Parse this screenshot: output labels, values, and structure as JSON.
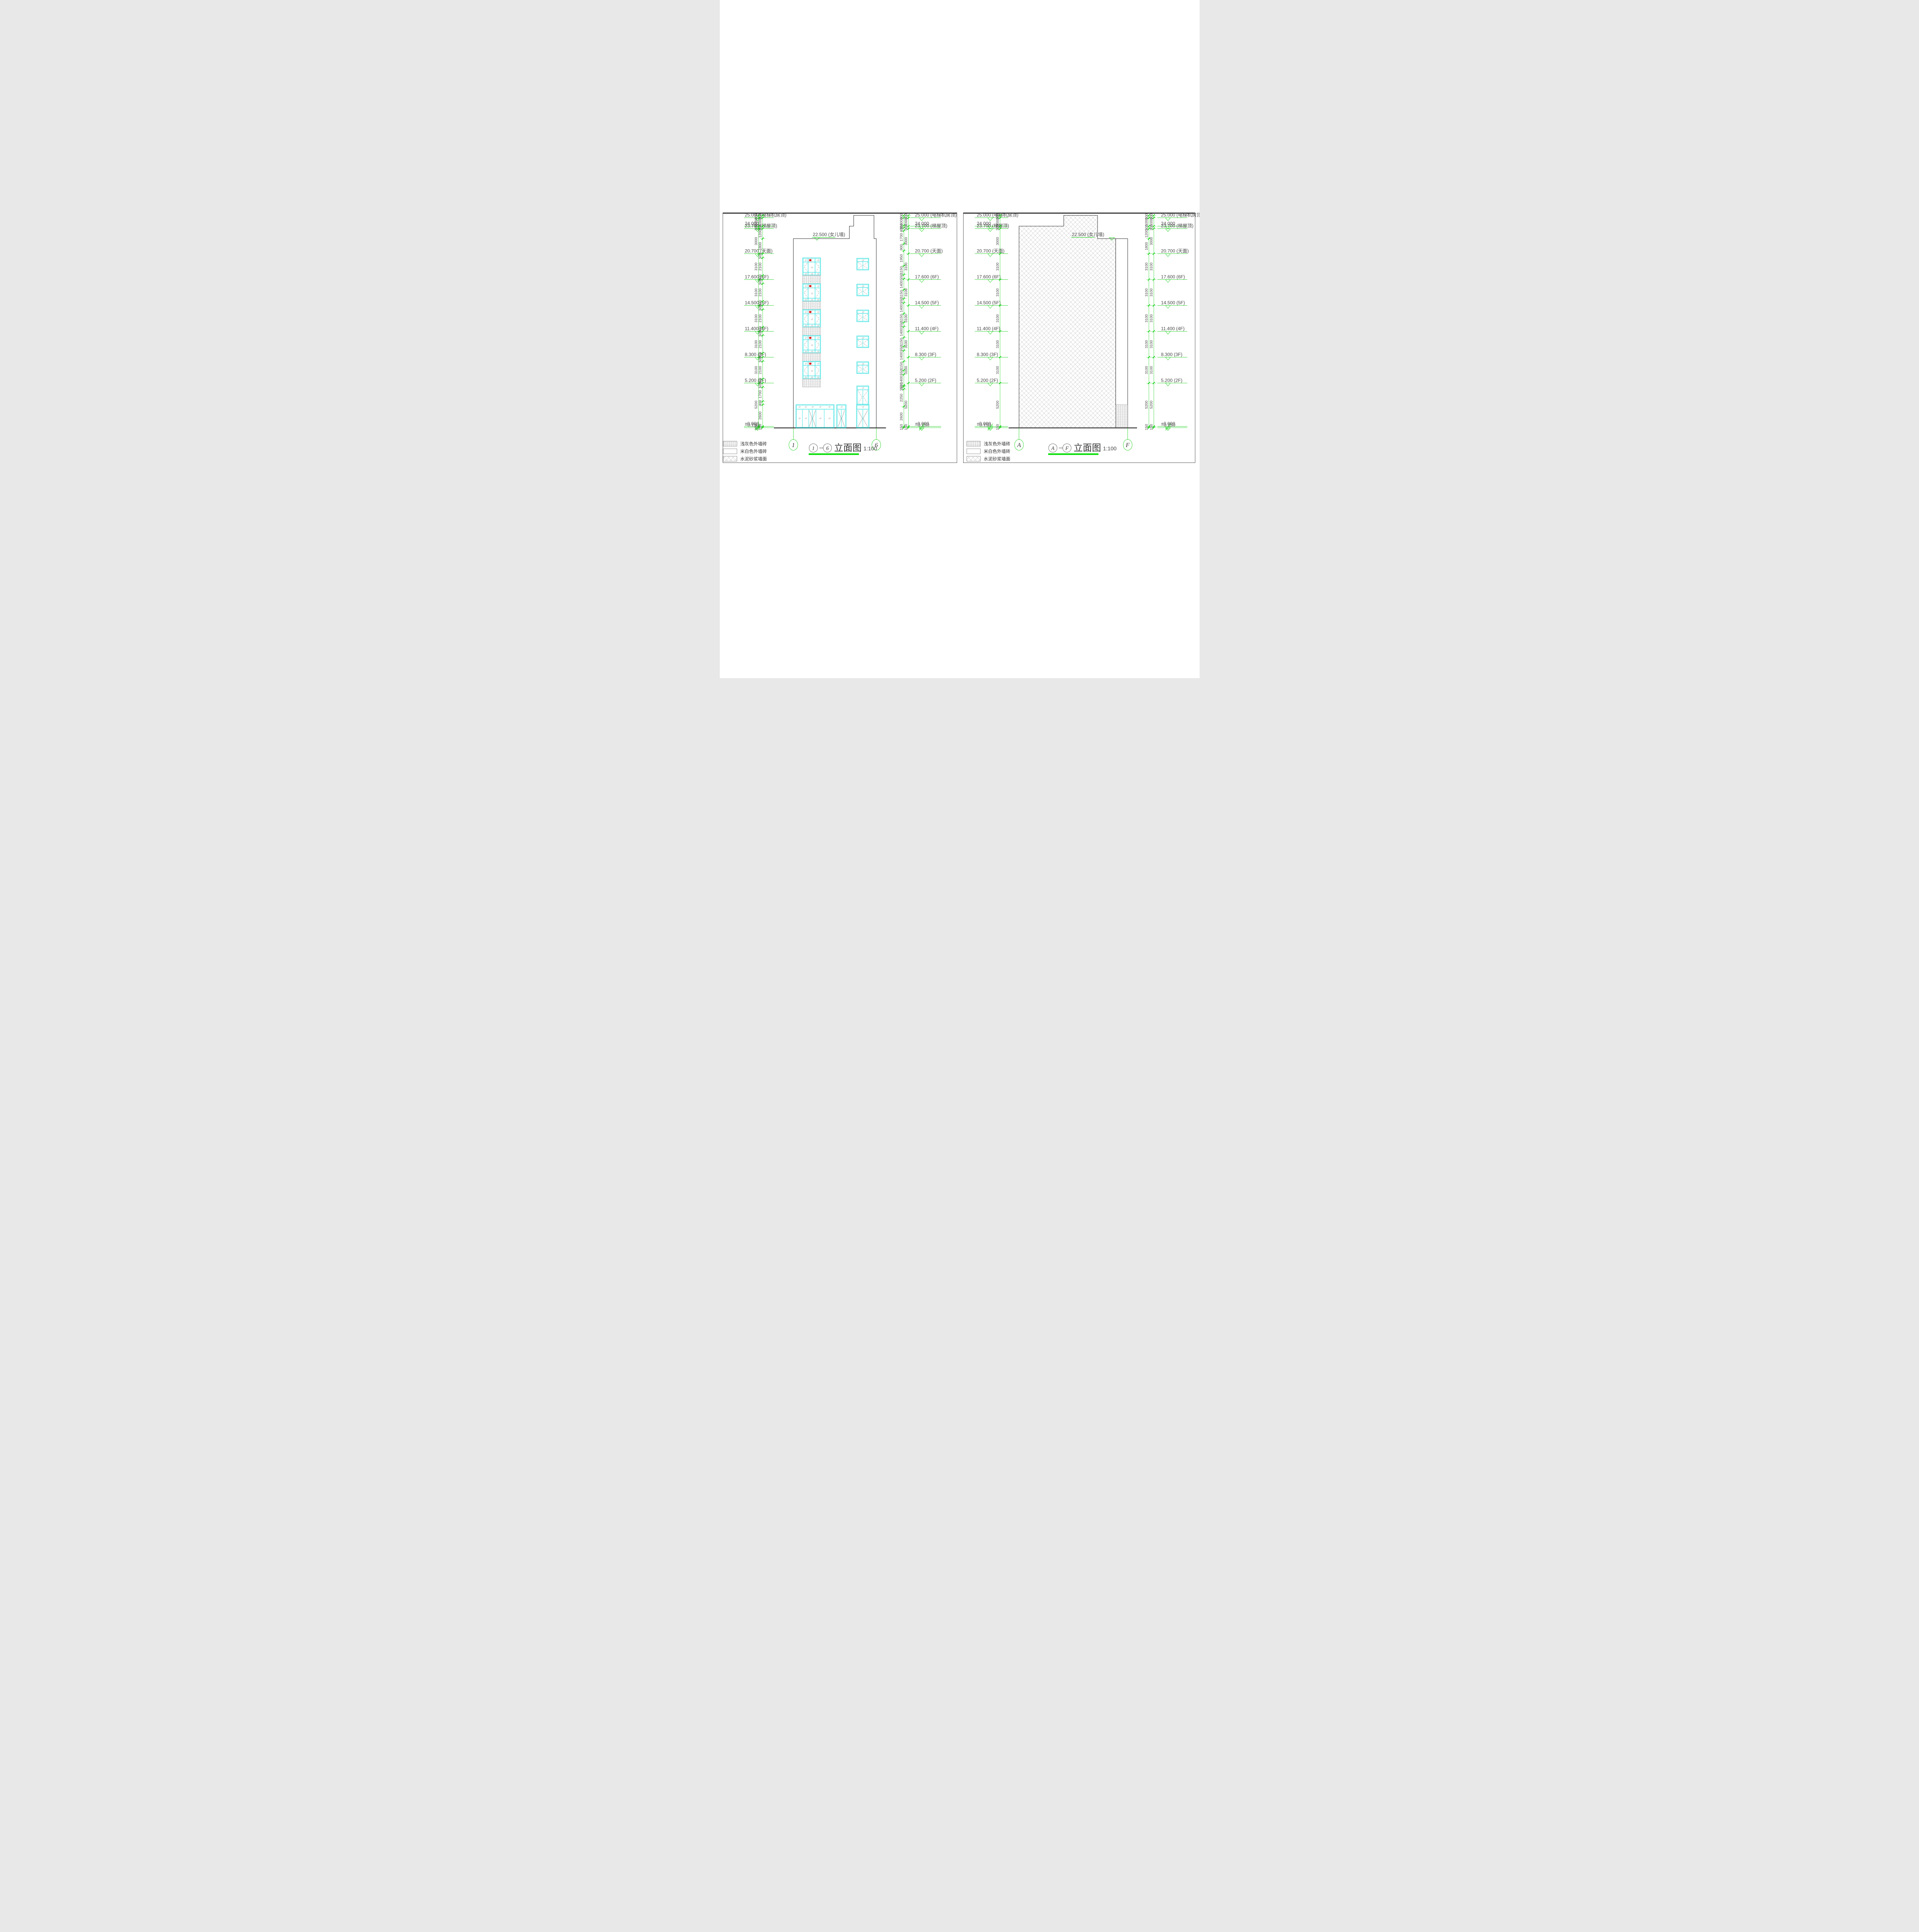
{
  "sheet": {
    "type_note": "architectural elevation sheet",
    "scale_text": "1:100"
  },
  "colors": {
    "cad_green": "#00CC00",
    "title_underline_green": "#00DD00",
    "window_cyan": "#00D8D8",
    "marker_red": "#E01010",
    "line_ink": "#2B2B2B",
    "hatch_gray": "#979797",
    "dim_text": "#4A4A4A"
  },
  "levels": [
    {
      "v": 25.0,
      "label": "25.000 (电梯机房顶)"
    },
    {
      "v": 24.0,
      "label": "24.000"
    },
    {
      "v": 23.7,
      "label": "23.700 (梯屋顶)"
    },
    {
      "v": 20.7,
      "label": "20.700 (天面)"
    },
    {
      "v": 17.6,
      "label": "17.600 (6F)"
    },
    {
      "v": 14.5,
      "label": "14.500 (5F)"
    },
    {
      "v": 11.4,
      "label": "11.400 (4F)"
    },
    {
      "v": 8.3,
      "label": "8.300 (3F)"
    },
    {
      "v": 5.2,
      "label": "5.200 (2F)"
    },
    {
      "v": 0.0,
      "label": "±0.000"
    },
    {
      "v": -0.15,
      "label": "−0.150"
    }
  ],
  "parapet_label": "22.500 (女儿墙)",
  "legend": [
    {
      "name": "浅灰色外墙砖",
      "pattern": "vlines"
    },
    {
      "name": "米白色外墙砖",
      "pattern": "blank"
    },
    {
      "name": "水泥砂浆墙面",
      "pattern": "crosshatch"
    }
  ],
  "panel_left": {
    "title": {
      "from": "1",
      "to": "6",
      "dash": "—",
      "text": "立面图",
      "scale": "1:100"
    },
    "grid_bubbles": [
      "1",
      "6"
    ],
    "dims_left_outer": [
      300,
      1000,
      300,
      3000,
      3100,
      3100,
      3100,
      3100,
      3100,
      5200,
      150
    ],
    "dims_left_inner": [
      300,
      1000,
      300,
      1200,
      1800,
      500,
      2100,
      500,
      500,
      2100,
      500,
      500,
      2100,
      500,
      500,
      2100,
      500,
      500,
      2100,
      500,
      500,
      1700,
      400,
      2600,
      150
    ],
    "dims_right_inner": [
      300,
      1000,
      300,
      400,
      1700,
      900,
      1950,
      1150,
      550,
      1400,
      1150,
      550,
      1400,
      1150,
      550,
      1400,
      1150,
      550,
      1400,
      1150,
      550,
      1400,
      150,
      350,
      2250,
      2600,
      150
    ],
    "dims_right_outer": [
      300,
      1000,
      300,
      3000,
      3100,
      3100,
      3100,
      3100,
      3100,
      5200,
      150
    ]
  },
  "panel_right": {
    "title": {
      "from": "A",
      "to": "F",
      "dash": "—",
      "text": "立面图",
      "scale": "1:100"
    },
    "grid_bubbles": [
      "A",
      "F"
    ],
    "dims_left_outer": [
      300,
      1000,
      300,
      3000,
      3100,
      3100,
      3100,
      3100,
      3100,
      5200,
      150
    ],
    "dims_right_inner": [
      300,
      1000,
      300,
      1200,
      1800,
      3100,
      3100,
      3100,
      3100,
      3100,
      5200,
      150
    ],
    "dims_right_outer": [
      300,
      1000,
      300,
      3000,
      3100,
      3100,
      3100,
      3100,
      3100,
      5200,
      150
    ]
  }
}
